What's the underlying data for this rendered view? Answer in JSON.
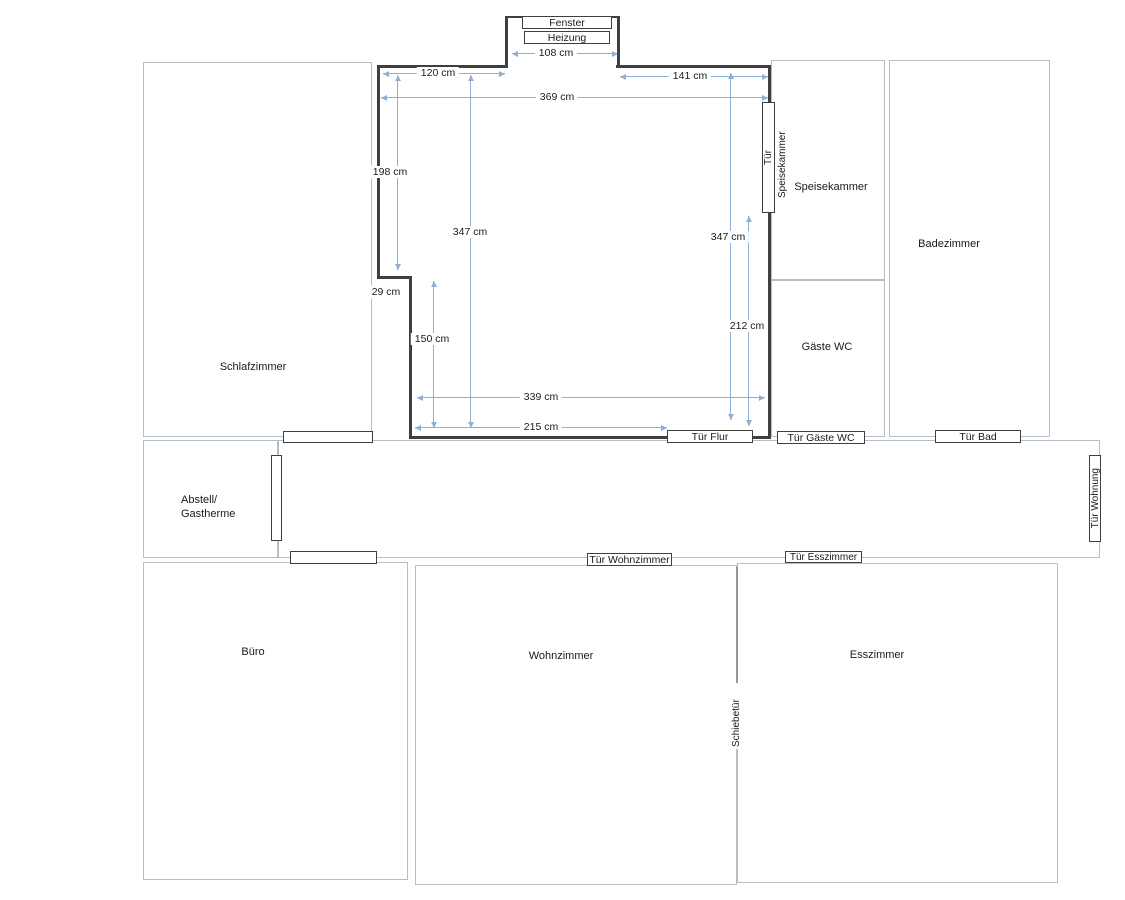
{
  "rooms": {
    "schlafzimmer": "Schlafzimmer",
    "speisekammer": "Speisekammer",
    "badezimmer": "Badezimmer",
    "gaeste_wc": "Gäste WC",
    "abstell_line1": "Abstell/",
    "abstell_line2": "Gastherme",
    "buero": "Büro",
    "wohnzimmer": "Wohnzimmer",
    "esszimmer": "Esszimmer"
  },
  "fixtures": {
    "fenster": "Fenster",
    "heizung": "Heizung"
  },
  "doors": {
    "flur": "Tür Flur",
    "gaeste_wc": "Tür Gäste WC",
    "bad": "Tür Bad",
    "wohnung": "Tür Wohnung",
    "wohnzimmer": "Tür Wohnzimmer",
    "esszimmer": "Tür Esszimmer",
    "schiebetuer": "Schiebetür",
    "speisekammer_tuer": "Tür",
    "speisekammer_side": "Speisekammer"
  },
  "measurements": {
    "window_bay_width": "108 cm",
    "top_wall_left": "120 cm",
    "top_wall_right": "141 cm",
    "full_width": "369 cm",
    "left_wall_upper": "198 cm",
    "notch_depth": "29 cm",
    "room_height_left": "347 cm",
    "left_wall_lower": "150 cm",
    "room_height_right": "347 cm",
    "right_wall_lower": "212 cm",
    "bottom_full": "339 cm",
    "bottom_left": "215 cm"
  },
  "colors": {
    "wall": "#3f3f3f",
    "room_border": "#b6bfc8",
    "measure_line": "#8fb0d6"
  }
}
